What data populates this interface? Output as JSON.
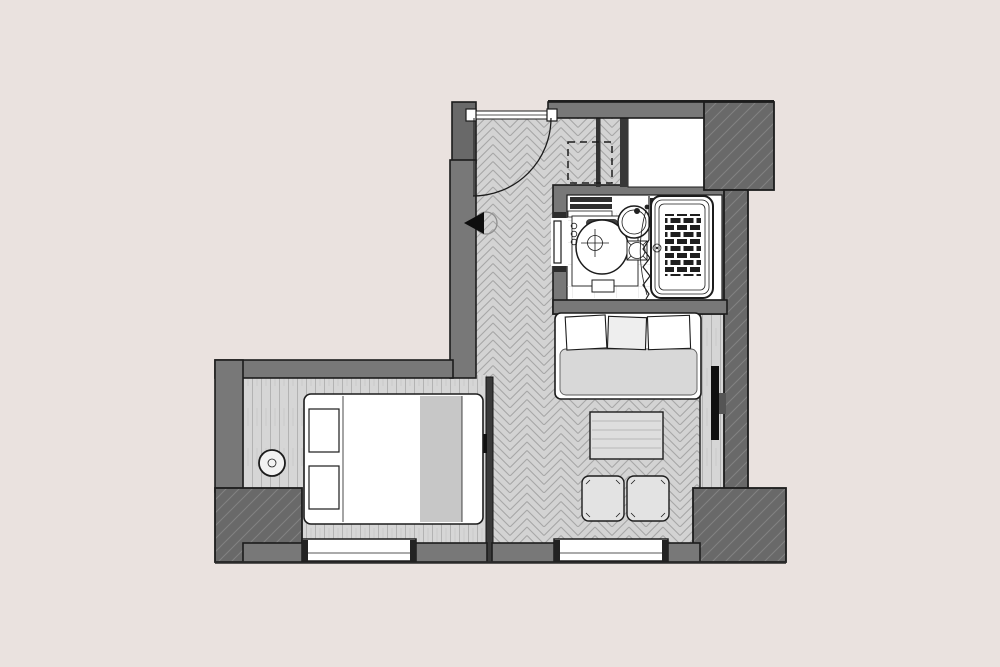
{
  "title": "Studio hotel room floor plan",
  "colors": {
    "background": "#EAE2DF",
    "wallMid": "#787878",
    "wallDark": "#696969",
    "hatchLine": "#828282",
    "outline": "#1C1C1C",
    "floor": "#D3D3D3",
    "floorLine": "#A7A7A7",
    "plankFloor": "#D6D6D6",
    "plankLine": "#B3B3B3",
    "tileLine": "#CFCFCF",
    "furnitureWhite": "#FFFFFF",
    "furnitureGray": "#D8D8D8",
    "brick": "#1F1F1F",
    "tv": "#101010"
  },
  "rooms": [
    {
      "name": "entry-hall",
      "floor": "herringbone-parquet",
      "features": [
        "entry-door-swing",
        "wall-sconce",
        "dashed-storage-outline"
      ]
    },
    {
      "name": "bathroom",
      "floor": "white-tile",
      "fixtures": [
        "toilet",
        "round-washbasin",
        "shower-with-mosaic-tray",
        "folding-shower-door",
        "pocket-door"
      ]
    },
    {
      "name": "closet-niche",
      "floor": "plain-white",
      "fixtures": []
    },
    {
      "name": "bedroom",
      "floor": "wood-planks",
      "furniture": [
        "double-bed",
        "two-pillows",
        "round-side-table"
      ],
      "openings": [
        "window"
      ]
    },
    {
      "name": "living-area",
      "floor": "herringbone-parquet",
      "furniture": [
        "daybed-sofa-with-three-pillows",
        "ottoman-table",
        "stool",
        "stool",
        "wall-mounted-tv",
        "media-ledge"
      ],
      "openings": [
        "window"
      ]
    }
  ],
  "structure": {
    "wall_blocks": [
      "top-right-column",
      "bottom-right-column",
      "bottom-left-column",
      "top-left-entry-column"
    ],
    "windows": 2,
    "doors": [
      "entry-swing-door",
      "bathroom-pocket-door",
      "shower-folding-door"
    ]
  }
}
